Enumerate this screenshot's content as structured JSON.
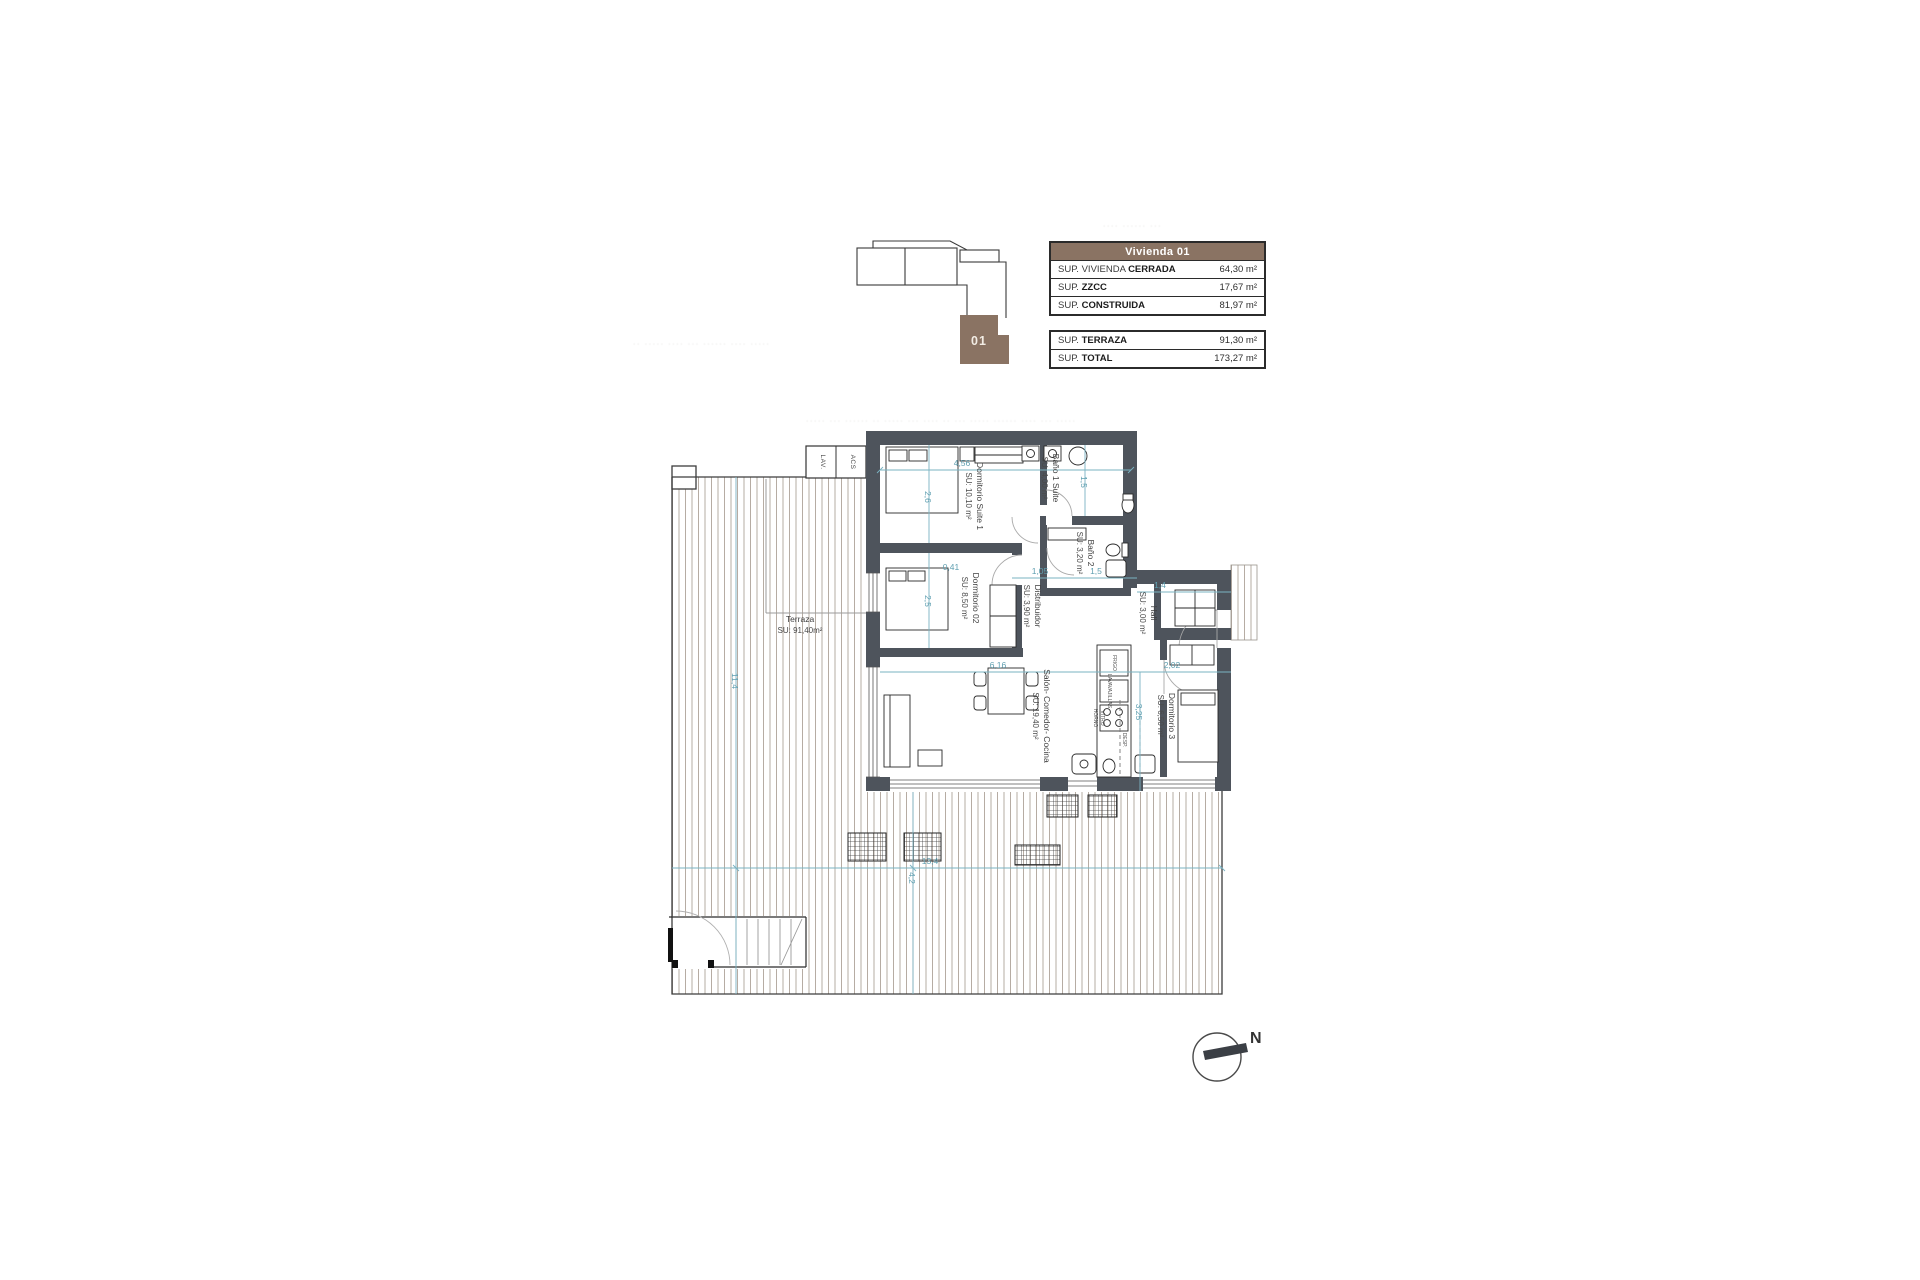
{
  "key_plan": {
    "unit_label": "01"
  },
  "area_table": {
    "header": "Vivienda 01",
    "rows": [
      {
        "label": "SUP. VIVIENDA ",
        "label_bold": "CERRADA",
        "value": "64,30 m²"
      },
      {
        "label": "SUP. ",
        "label_bold": "ZZCC",
        "value": "17,67 m²"
      },
      {
        "label": "SUP. ",
        "label_bold": "CONSTRUIDA",
        "value": "81,97 m²"
      }
    ]
  },
  "totals_table": {
    "rows": [
      {
        "label": "SUP. ",
        "label_bold": "TERRAZA",
        "value": "91,30 m²"
      },
      {
        "label": "SUP. ",
        "label_bold": "TOTAL",
        "value": "173,27 m²"
      }
    ]
  },
  "rooms": [
    {
      "name": "Dormitorio Suite 1",
      "area": "SU: 10,10 m²"
    },
    {
      "name": "Baño 1 Suite",
      "area": "SU: 4,00 m²"
    },
    {
      "name": "Baño 2",
      "area": "SU: 3,20 m²"
    },
    {
      "name": "Dormitorio 02",
      "area": "SU: 8,50 m²"
    },
    {
      "name": "Distribuidor",
      "area": "SU: 3,90 m²"
    },
    {
      "name": "Hall",
      "area": "SU: 3,00 m²"
    },
    {
      "name": "Dormitorio 3",
      "area": "SU: 6,50 m²"
    },
    {
      "name": "Salón- Comedor- Cocina",
      "area": "SU: 19,40 m²"
    },
    {
      "name": "Terraza",
      "area": "SU: 91,40m²"
    }
  ],
  "closets": [
    "LAV.",
    "ACS"
  ],
  "kitchen_labels": [
    "FRIGO",
    "LAVAVAJILLAS",
    "HORNO",
    "VITRO",
    "DESP."
  ],
  "dims": [
    "4,56",
    "2,6",
    "1,5",
    "0,41",
    "2,5",
    "1,05",
    "1,5",
    "1,4",
    "6,16",
    "2,02",
    "3,25",
    "13,4",
    "4,2",
    "11,4"
  ],
  "compass": {
    "north_label": "N"
  },
  "watermarks": {
    "line1": "·· ····· ···· ··· ······ ···· ·····",
    "line2": "····· ··· ······ ·· ····· ··· ···· ·· ··· ····· ······ ···· ··· ·····",
    "line3": "···· ······ ···"
  },
  "colors": {
    "brown": "#8a7363",
    "wall": "#4e545c",
    "dim_line": "#7ab3c2",
    "hatch": "#b6aca3"
  }
}
